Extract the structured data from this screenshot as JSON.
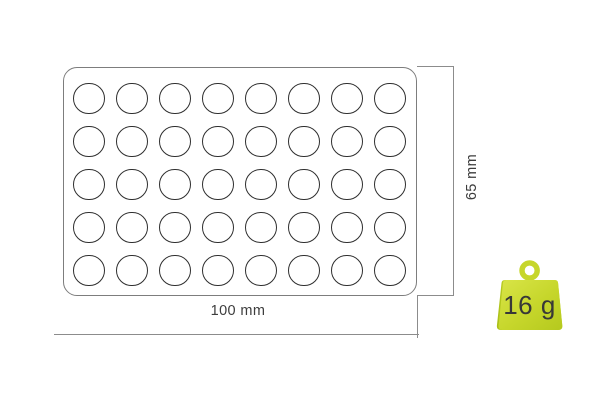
{
  "diagram": {
    "type": "product-dimension-diagram",
    "subject": "baking-mold-with-round-cavities",
    "width_label": "100 mm",
    "height_label": "65 mm",
    "weight_label": "16 g",
    "grid": {
      "rows": 5,
      "columns": 8,
      "total_cavities": 40,
      "cavity_shape": "circle"
    },
    "colors": {
      "mold_outline": "#7d7d7d",
      "cavity_stroke": "#2f2f2f",
      "dimension_line": "#8c8c8c",
      "label_text": "#3d3d3d",
      "weight_green": "#c6d62b",
      "weight_green_light": "#d9e548",
      "weight_green_dark": "#a9bf16",
      "weight_text": "#383838"
    }
  }
}
